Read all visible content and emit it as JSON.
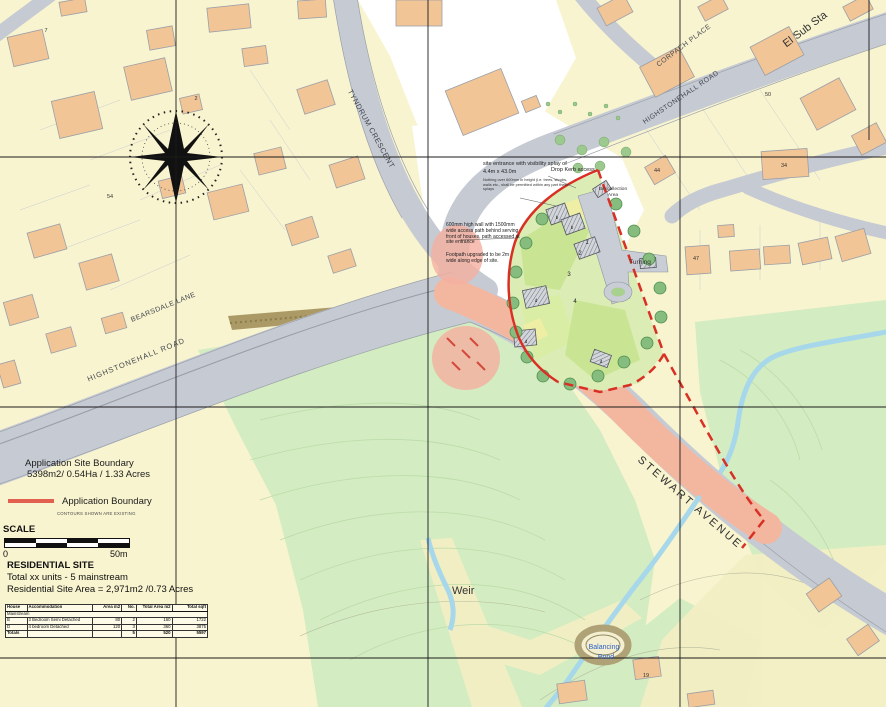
{
  "roads": {
    "tyndrum_crescent": "TYNDRUM CRESCENT",
    "corpach_place": "CORPACH PLACE",
    "highstonehall_road_top": "HIGHSTONEHALL ROAD",
    "bearsdale_lane": "BEARSDALE LANE",
    "highstonehall_road_left": "HIGHSTONEHALL ROAD",
    "stewart_avenue": "STEWART AVENUE"
  },
  "places": {
    "el_sub_sta": "El Sub Sta",
    "weir": "Weir",
    "balancing_pond_line1": "Balancing",
    "balancing_pond_line2": "Pond",
    "turning": "Turning",
    "bin_collection_line1": "Bin collection",
    "bin_collection_line2": "Area"
  },
  "annotations": {
    "entrance_line1": "site entrance with visibility splay of",
    "entrance_line2": "4.4m x 43.0m",
    "entrance_small": "Nothing over 600mm in height (i.e. trees, shrubs, walls etc., shall be permitted within any part these splays",
    "drop_kerb": "Drop Kerb access",
    "wall_note": "600mm high wall with 1500mm wide access path behind serving front of houses, path accessed at site entrance",
    "footpath_note": "Footpath upgraded to be 2m wide along edge of site."
  },
  "site": {
    "plot_numbers": [
      "1",
      "2",
      "3",
      "4"
    ],
    "house_letters": [
      "b",
      "b",
      "d",
      "d",
      "d"
    ]
  },
  "house_numbers": {
    "hn1": "7",
    "hn2": "2",
    "hn3": "54",
    "hn4": "50",
    "hn5": "44",
    "hn6": "34",
    "hn7": "47",
    "hn8": "19"
  },
  "legend": {
    "site_boundary_line1": "Application Site Boundary",
    "site_boundary_line2": "5398m2/ 0.54Ha / 1.33 Acres",
    "application_boundary_label": "Application Boundary",
    "contours_note": "CONTOURS SHOWN ARE EXISTING",
    "application_boundary_color": "#e2604f"
  },
  "scale": {
    "label": "SCALE",
    "zero": "0",
    "max": "50m"
  },
  "residential": {
    "title": "RESIDENTIAL SITE",
    "units_line": "Total xx units - 5 mainstream",
    "area_line": "Residential Site Area = 2,971m2 /0.73 Acres",
    "table": {
      "headers": [
        "House",
        "Accommodation",
        "Area m2",
        "No.",
        "Total Area m2",
        "Total sqft"
      ],
      "section_label": "Mainstream",
      "rows": [
        [
          "B",
          "3 Bedroom Semi Detached",
          "80",
          "2",
          "160",
          "1722"
        ],
        [
          "D",
          "4 bedroom Detached",
          "120",
          "3",
          "360",
          "3875"
        ]
      ],
      "totals_label": "Totals",
      "totals": [
        "5",
        "520",
        "5597"
      ]
    }
  },
  "colors": {
    "base_yellow": "#f8f4cf",
    "field_green": "#d3ecc1",
    "road_grey": "#c6cad3",
    "building_orange": "#f2c596",
    "application_red": "#d93025",
    "highlight_road_salmon": "#f3b7a0",
    "water_blue": "#a6d7ea",
    "site_green": "#dbedb5"
  }
}
